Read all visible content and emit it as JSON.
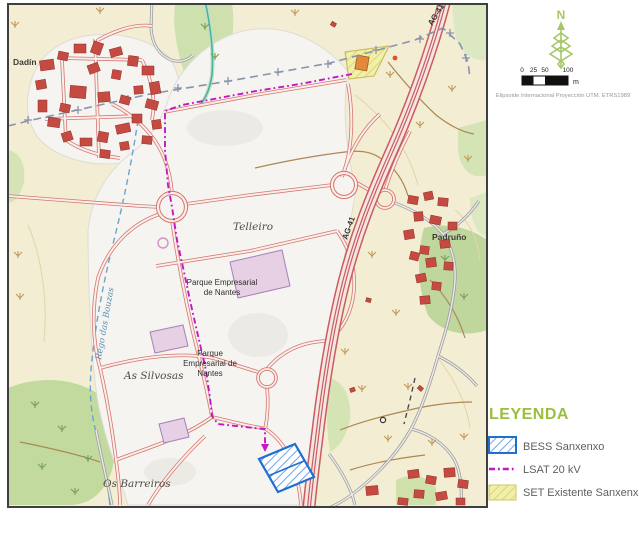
{
  "map": {
    "labels": {
      "dadin": "Dadín",
      "padruno": "Padruño",
      "telleiro": "Telleiro",
      "as_silvosas": "As Silvosas",
      "os_barreiros": "Os Barreiros",
      "parque_a_line1": "Parque Empresarial",
      "parque_a_line2": "de Nantes",
      "parque_b_line1": "Parque",
      "parque_b_line2": "Empresarial de",
      "parque_b_line3": "Nantes",
      "stream": "Rego das Bouzas",
      "highway": "AG-41",
      "highway_top": "AG-41"
    },
    "colors": {
      "background": "#f3eed3",
      "urban": "#f5f4f0",
      "forest": "#cde0ae",
      "road_casing": "#d4766f",
      "road_fill": "#fbeeea",
      "highway_red": "#c95c5c",
      "stream_blue": "#6aa6cc",
      "boundary_gray": "#8a93ad",
      "buildings_red": "#c54b42",
      "industrial_pink": "#e7cfe4",
      "lsat_magenta": "#c517c5",
      "bess_blue": "#1e6fd2",
      "set_yellow": "#f2f0a8",
      "legend_title_green": "#9cbe3f"
    }
  },
  "compass": {
    "north_label": "N"
  },
  "scale_bar": {
    "tick_labels": [
      "0",
      "25",
      "50",
      "100"
    ],
    "unit": "m",
    "caption": "Elipsoide Internacional Proyección UTM. ETRS1989"
  },
  "legend": {
    "title": "LEYENDA",
    "items": [
      {
        "label": "BESS Sanxenxo"
      },
      {
        "label": "LSAT 20 kV"
      },
      {
        "label": "SET Existente Sanxenxo"
      }
    ]
  }
}
